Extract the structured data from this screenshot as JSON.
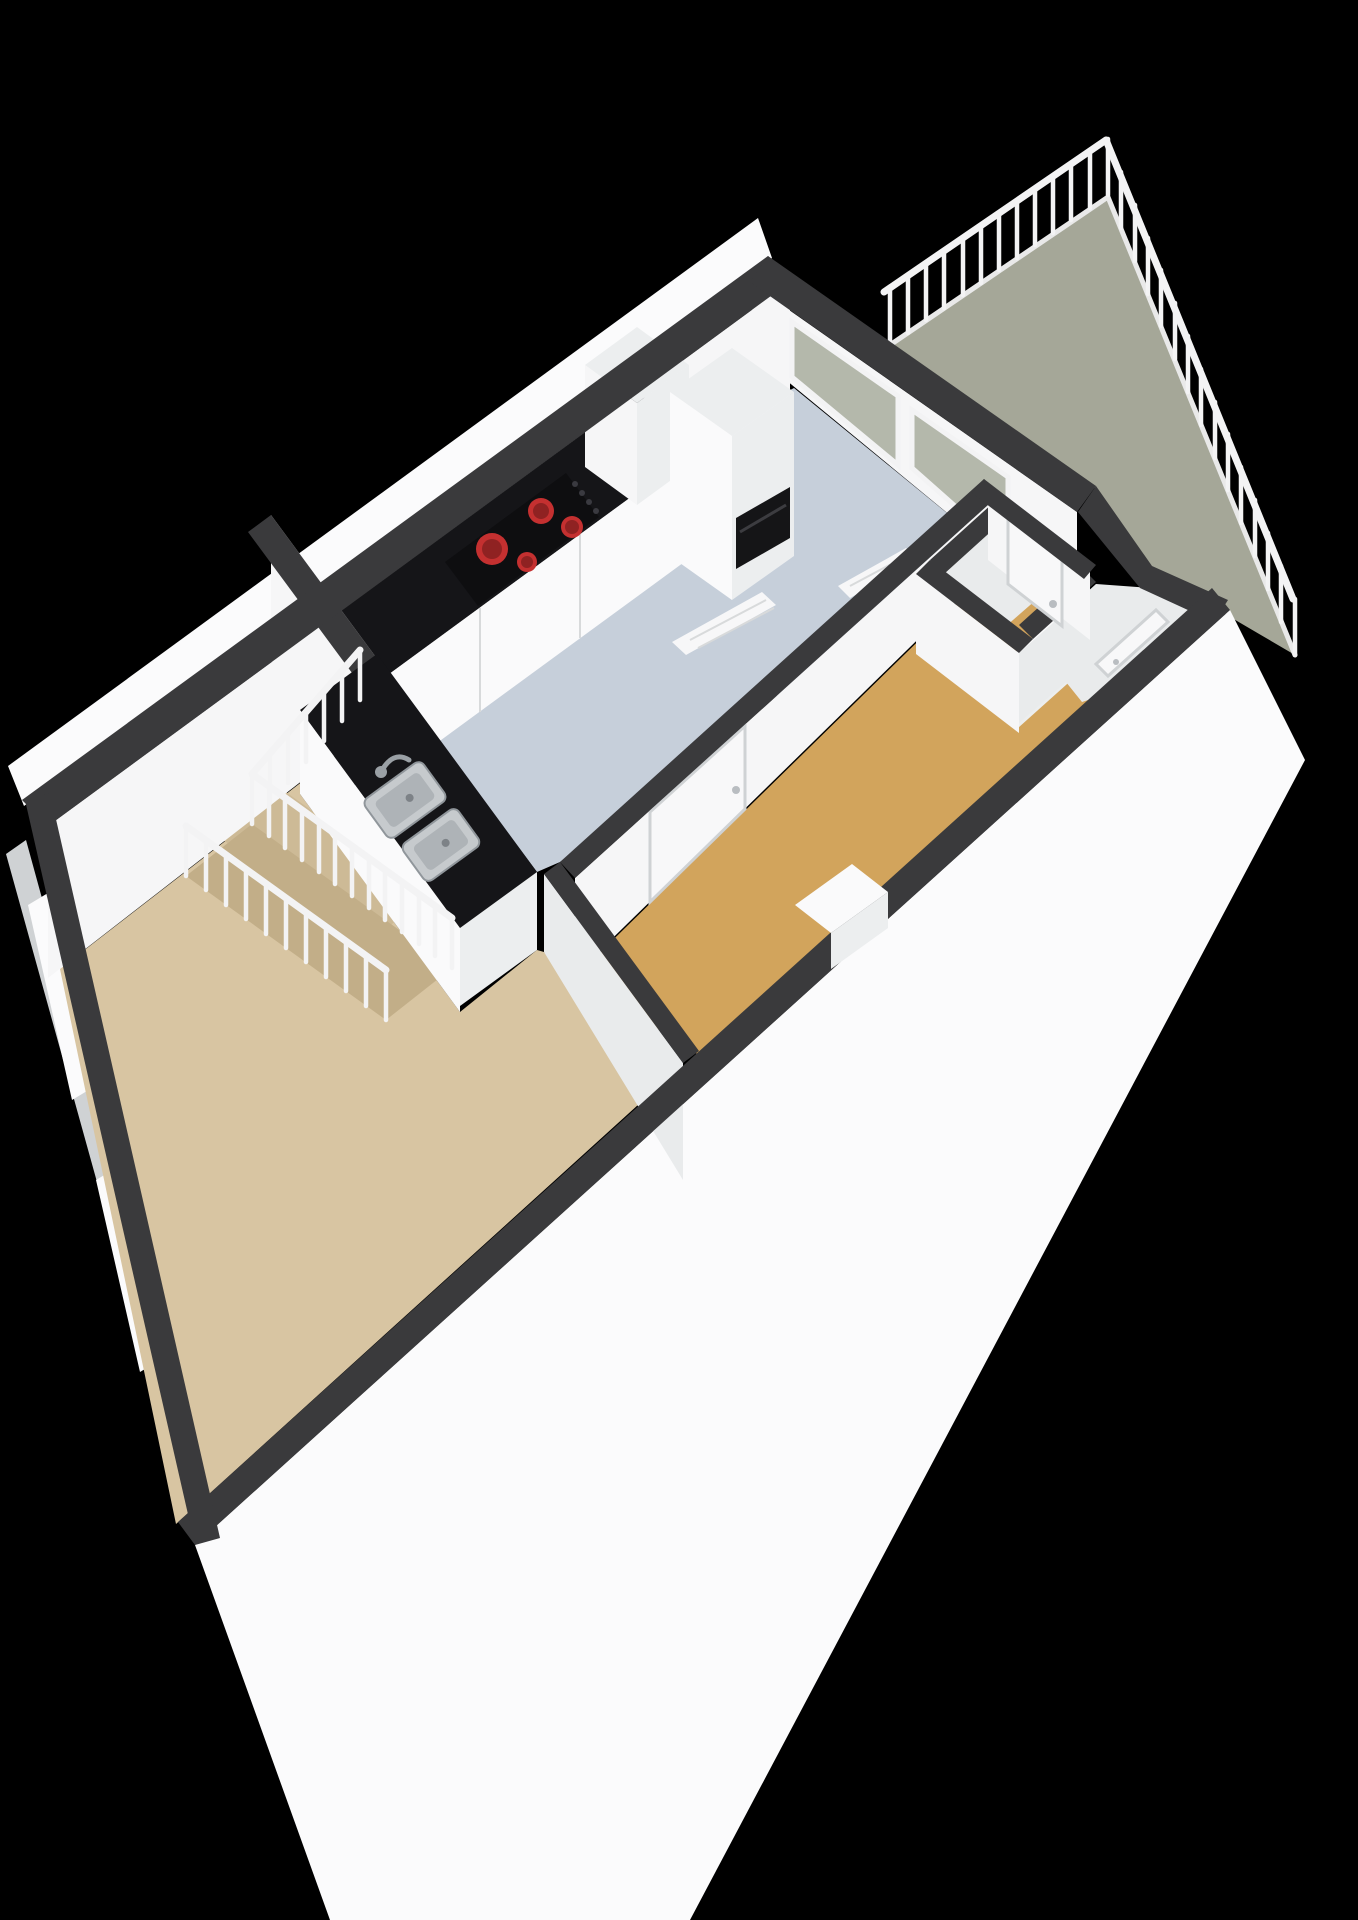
{
  "scene": {
    "type": "3d-floorplan-render",
    "view": "isometric aerial cutaway, apartment floor seen from south-east, black background",
    "text_labels": "none visible in render"
  },
  "colors": {
    "background": "#000000",
    "wall_top": "#3a3a3c",
    "wall_white": "#f6f6f7",
    "wall_shade": "#e9ebec",
    "exterior_face": "#fbfbfc",
    "frame_gray": "#cfd2d4",
    "balcony_floor": "#a5a798",
    "kitchen_floor": "#c6cfda",
    "living_floor": "#d8c5a2",
    "landing_floor": "#cdba96",
    "stair_hole": "#c2ae88",
    "bedroom_floor": "#d2a45c",
    "counter_black": "#151518",
    "cooktop_black": "#0e0e10",
    "burner_red": "#c43030",
    "burner_red_dark": "#8f2222",
    "cabinet_white": "#fafafb",
    "cabinet_shade": "#eceeef",
    "door_white": "#f8f8f9",
    "railing": "#f3f3f4",
    "glass": "#b4b8ab",
    "radiator_white": "#f7f7f8",
    "steel": "#c6cacd",
    "steel_dark": "#90969b",
    "steel_inner": "#aeb3b7",
    "oven_black": "#151517",
    "meter_red": "#cc3333",
    "meter_dark": "#222226",
    "handle_gray": "#b9bdc1"
  },
  "rooms": [
    {
      "id": "balcony",
      "floor": "balcony_floor"
    },
    {
      "id": "kitchen-hallway",
      "floor": "kitchen_floor"
    },
    {
      "id": "living-room",
      "floor": "living_floor"
    },
    {
      "id": "bedroom",
      "floor": "bedroom_floor"
    },
    {
      "id": "stair-landing",
      "floor": "landing_floor"
    },
    {
      "id": "meter-closet",
      "floor": "wall_shade"
    }
  ],
  "fixtures": {
    "cooktop_burners": 4,
    "sink_basins": 2,
    "interior_doors": 4,
    "tall_kitchen_cabinets": 2,
    "radiators": 2,
    "railings": [
      "balcony-railing",
      "stair-railing"
    ]
  }
}
